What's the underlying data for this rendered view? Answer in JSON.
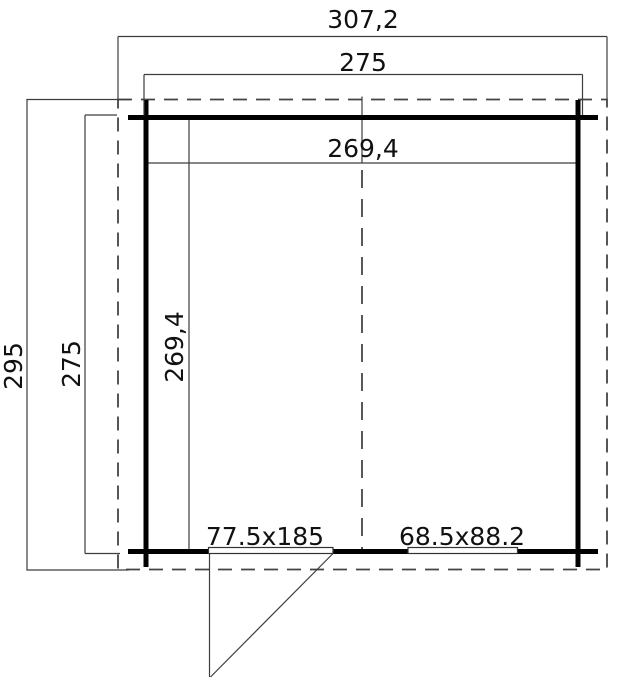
{
  "plan": {
    "type": "floor-plan technical drawing of a cabin with door and window",
    "dimensions": {
      "overall_width": "307,2",
      "outer_wall_width": "275",
      "inner_width": "269,4",
      "overall_depth": "295",
      "outer_wall_depth": "275",
      "inner_depth": "269,4"
    },
    "openings": {
      "door_label": "77.5x185",
      "window_label": "68.5x88.2"
    },
    "colors": {
      "background": "#ffffff",
      "wall": "#000000",
      "thin_line": "#3d3d3d",
      "dashed_line": "#444444",
      "text": "#111111"
    }
  }
}
